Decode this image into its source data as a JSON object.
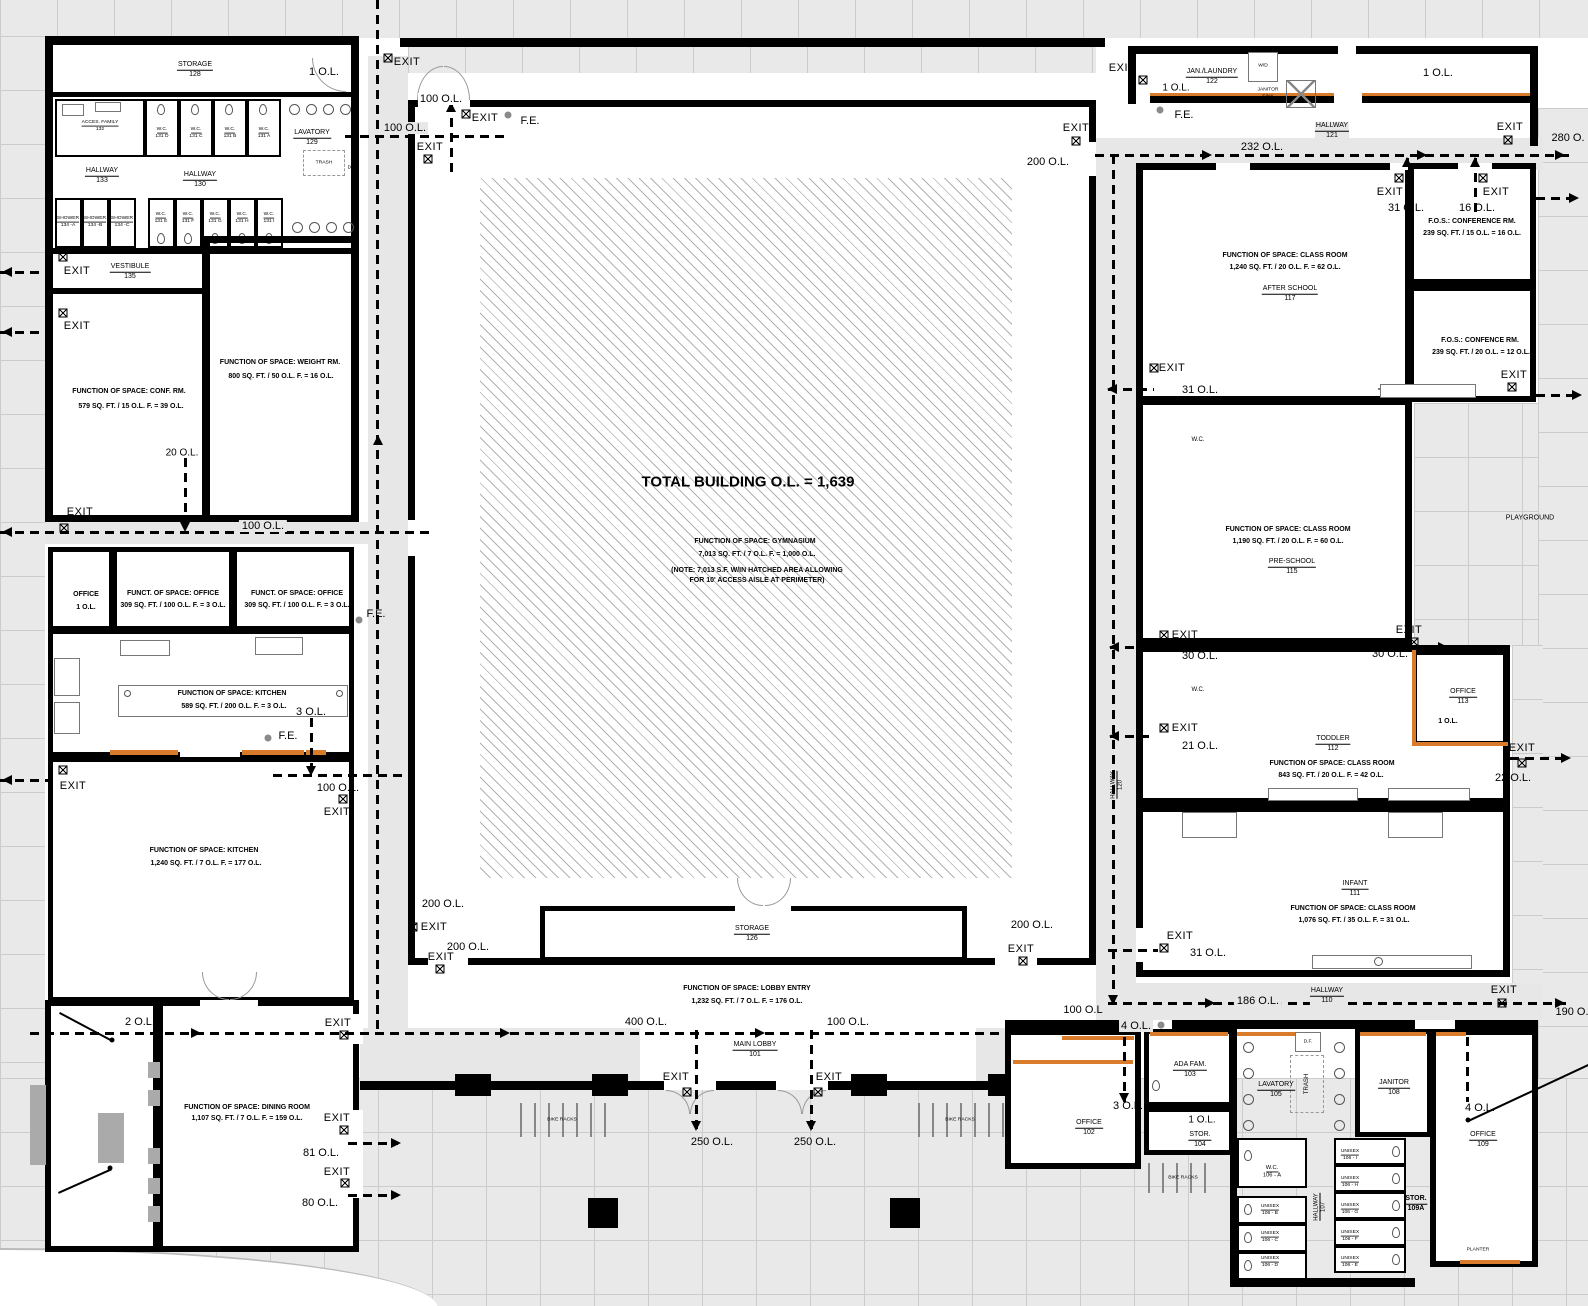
{
  "gym": {
    "total": "TOTAL BUILDING O.L. = 1,639",
    "fos": "FUNCTION OF SPACE:  GYMNASIUM",
    "calc": "7,013 SQ. FT. / 7 O.L. F. = 1,000 O.L.",
    "note1": "(NOTE:  7,013 S.F. W/IN HATCHED AREA ALLOWING",
    "note2": "FOR 10' ACCESS AISLE AT PERIMETER)"
  },
  "labels": {
    "exit": "EXIT",
    "fe": "F.E.",
    "wd": "W/D",
    "janitor_sink_1": "JANITOR",
    "janitor_sink_2": "SINK",
    "trash": "TRASH",
    "df": "D.F.",
    "wc": "W.C.",
    "playground": "PLAYGROUND",
    "planter": "PLANTER",
    "bike_racks": "BIKE RACKS"
  },
  "ol": {
    "n1": "1 O.L.",
    "n2": "2 O.L.",
    "n3": "3 O.L.",
    "n4": "4 O.L.",
    "n16": "16 O.L.",
    "n20": "20 O.L.",
    "n21": "21 O.L.",
    "n22": "22 O.L.",
    "n30": "30 O.L.",
    "n31": "31 O.L.",
    "n80": "80 O.L.",
    "n81": "81 O.L.",
    "n100": "100 O.L.",
    "n100b": "100 O.L",
    "n186": "186 O.L.",
    "n190": "190 O.",
    "n200": "200 O.L.",
    "n232": "232 O.L.",
    "n250": "250 O.L.",
    "n280": "280 O.",
    "n400": "400 O.L."
  },
  "rooms": {
    "storage128": {
      "name": "STORAGE",
      "num": "128"
    },
    "acces132": {
      "name": "ACCES. FAMILY",
      "num": "132"
    },
    "lav129": {
      "name": "LAVATORY",
      "num": "129"
    },
    "hall133": {
      "name": "HALLWAY",
      "num": "133"
    },
    "hall130": {
      "name": "HALLWAY",
      "num": "130"
    },
    "vest135": {
      "name": "VESTIBULE",
      "num": "135"
    },
    "conf": {
      "fos": "FUNCTION OF SPACE:  CONF. RM.",
      "calc": "579 SQ. FT. / 15 O.L. F. = 39 O.L."
    },
    "weight": {
      "fos": "FUNCTION OF SPACE:  WEIGHT RM.",
      "calc": "800 SQ. FT. / 50 O.L. F. = 16 O.L."
    },
    "office_sm": {
      "name": "OFFICE",
      "ol": "1 O.L."
    },
    "office_a": {
      "fos": "FUNCT. OF SPACE:  OFFICE",
      "calc": "309 SQ. FT. / 100 O.L. F. = 3 O.L."
    },
    "office_b": {
      "fos": "FUNCT. OF SPACE:  OFFICE",
      "calc": "309 SQ. FT. / 100 O.L. F. = 3 O.L."
    },
    "kitch_sm": {
      "fos": "FUNCTION OF SPACE:  KITCHEN",
      "calc": "589 SQ. FT. / 200 O.L. F. = 3 O.L."
    },
    "kitch_lg": {
      "fos": "FUNCTION OF SPACE:  KITCHEN",
      "calc": "1,240 SQ. FT. / 7 O.L. F. = 177 O.L."
    },
    "dining": {
      "fos": "FUNCTION OF SPACE:  DINING ROOM",
      "calc": "1,107 SQ. FT. / 7 O.L. F. = 159 O.L."
    },
    "stor126": {
      "name": "STORAGE",
      "num": "126"
    },
    "lobby_entry": {
      "fos": "FUNCTION OF SPACE:  LOBBY ENTRY",
      "calc": "1,232 SQ. FT. / 7 O.L. F. = 176 O.L."
    },
    "main_lobby": {
      "name": "MAIN LOBBY",
      "num": "101"
    },
    "jan122": {
      "name": "JAN./LAUNDRY",
      "num": "122"
    },
    "hall121": {
      "name": "HALLWAY",
      "num": "121"
    },
    "rm117": {
      "fos": "FUNCTION OF SPACE:  CLASS ROOM",
      "calc": "1,240 SQ. FT. / 20 O.L. F. = 62 O.L.",
      "name": "AFTER SCHOOL",
      "num": "117"
    },
    "conf_rm_a": {
      "fos": "F.O.S.:  CONFERENCE RM.",
      "calc": "239 SQ. FT. / 15 O.L. = 16 O.L."
    },
    "conf_rm_b": {
      "fos": "F.O.S.:  CONFENCE RM.",
      "calc": "239 SQ. FT. / 20 O.L. = 12 O.L."
    },
    "rm115": {
      "fos": "FUNCTION OF SPACE:  CLASS ROOM",
      "calc": "1,190 SQ. FT. / 20 O.L. F. = 60 O.L.",
      "name": "PRE-SCHOOL",
      "num": "115"
    },
    "office113": {
      "name": "OFFICE",
      "num": "113",
      "ol": "1 O.L."
    },
    "rm112": {
      "name": "TODDLER",
      "num": "112",
      "fos": "FUNCTION OF SPACE:  CLASS ROOM",
      "calc": "843 SQ. FT. / 20 O.L. F. = 42 O.L."
    },
    "rm111": {
      "name": "INFANT",
      "num": "111",
      "fos": "FUNCTION OF SPACE:  CLASS ROOM",
      "calc": "1,076 SQ. FT. / 35 O.L. F. = 31 O.L."
    },
    "hall120": {
      "name": "HALLWAY",
      "num": "120"
    },
    "hall110": {
      "name": "HALLWAY",
      "num": "110"
    },
    "office102": {
      "name": "OFFICE",
      "num": "102"
    },
    "ada103": {
      "name": "ADA FAM.",
      "num": "103"
    },
    "stor104": {
      "ol": "1 O.L.",
      "name": "STOR.",
      "num": "104"
    },
    "lav105": {
      "name": "LAVATORY",
      "num": "105"
    },
    "jan108": {
      "name": "JANITOR",
      "num": "108"
    },
    "office109": {
      "name": "OFFICE",
      "num": "109"
    },
    "hall107": {
      "name": "HALLWAY",
      "num": "107"
    },
    "stor109a": {
      "name": "STOR.",
      "num": "109A"
    },
    "stalls": {
      "wc_top": [
        {
          "a": "W.C.",
          "b": "131 D"
        },
        {
          "a": "W.C.",
          "b": "131 C"
        },
        {
          "a": "W.C.",
          "b": "131 B"
        },
        {
          "a": "W.C.",
          "b": "131 A"
        }
      ],
      "wc_bot": [
        {
          "a": "W.C.",
          "b": "131 E"
        },
        {
          "a": "W.C.",
          "b": "131 F"
        },
        {
          "a": "W.C.",
          "b": "131 G"
        },
        {
          "a": "W.C.",
          "b": "131 H"
        },
        {
          "a": "W.C.",
          "b": "131 I"
        }
      ],
      "showers": [
        {
          "a": "SHOWER",
          "b": "134 -A"
        },
        {
          "a": "SHOWER",
          "b": "134 -B"
        },
        {
          "a": "SHOWER",
          "b": "134 -C"
        }
      ],
      "right_left_col": [
        {
          "a": "W.C.",
          "b": "106 - A"
        },
        {
          "a": "UNISEX",
          "b": "106 - B"
        },
        {
          "a": "UNISEX",
          "b": "106 - C"
        },
        {
          "a": "UNISEX",
          "b": "106 - D"
        }
      ],
      "right_right_col": [
        {
          "a": "UNISEX",
          "b": "106 - I"
        },
        {
          "a": "UNISEX",
          "b": "106 - H"
        },
        {
          "a": "UNISEX",
          "b": "106 - G"
        },
        {
          "a": "UNISEX",
          "b": "106 - F"
        },
        {
          "a": "UNISEX",
          "b": "106 - E"
        }
      ]
    }
  }
}
